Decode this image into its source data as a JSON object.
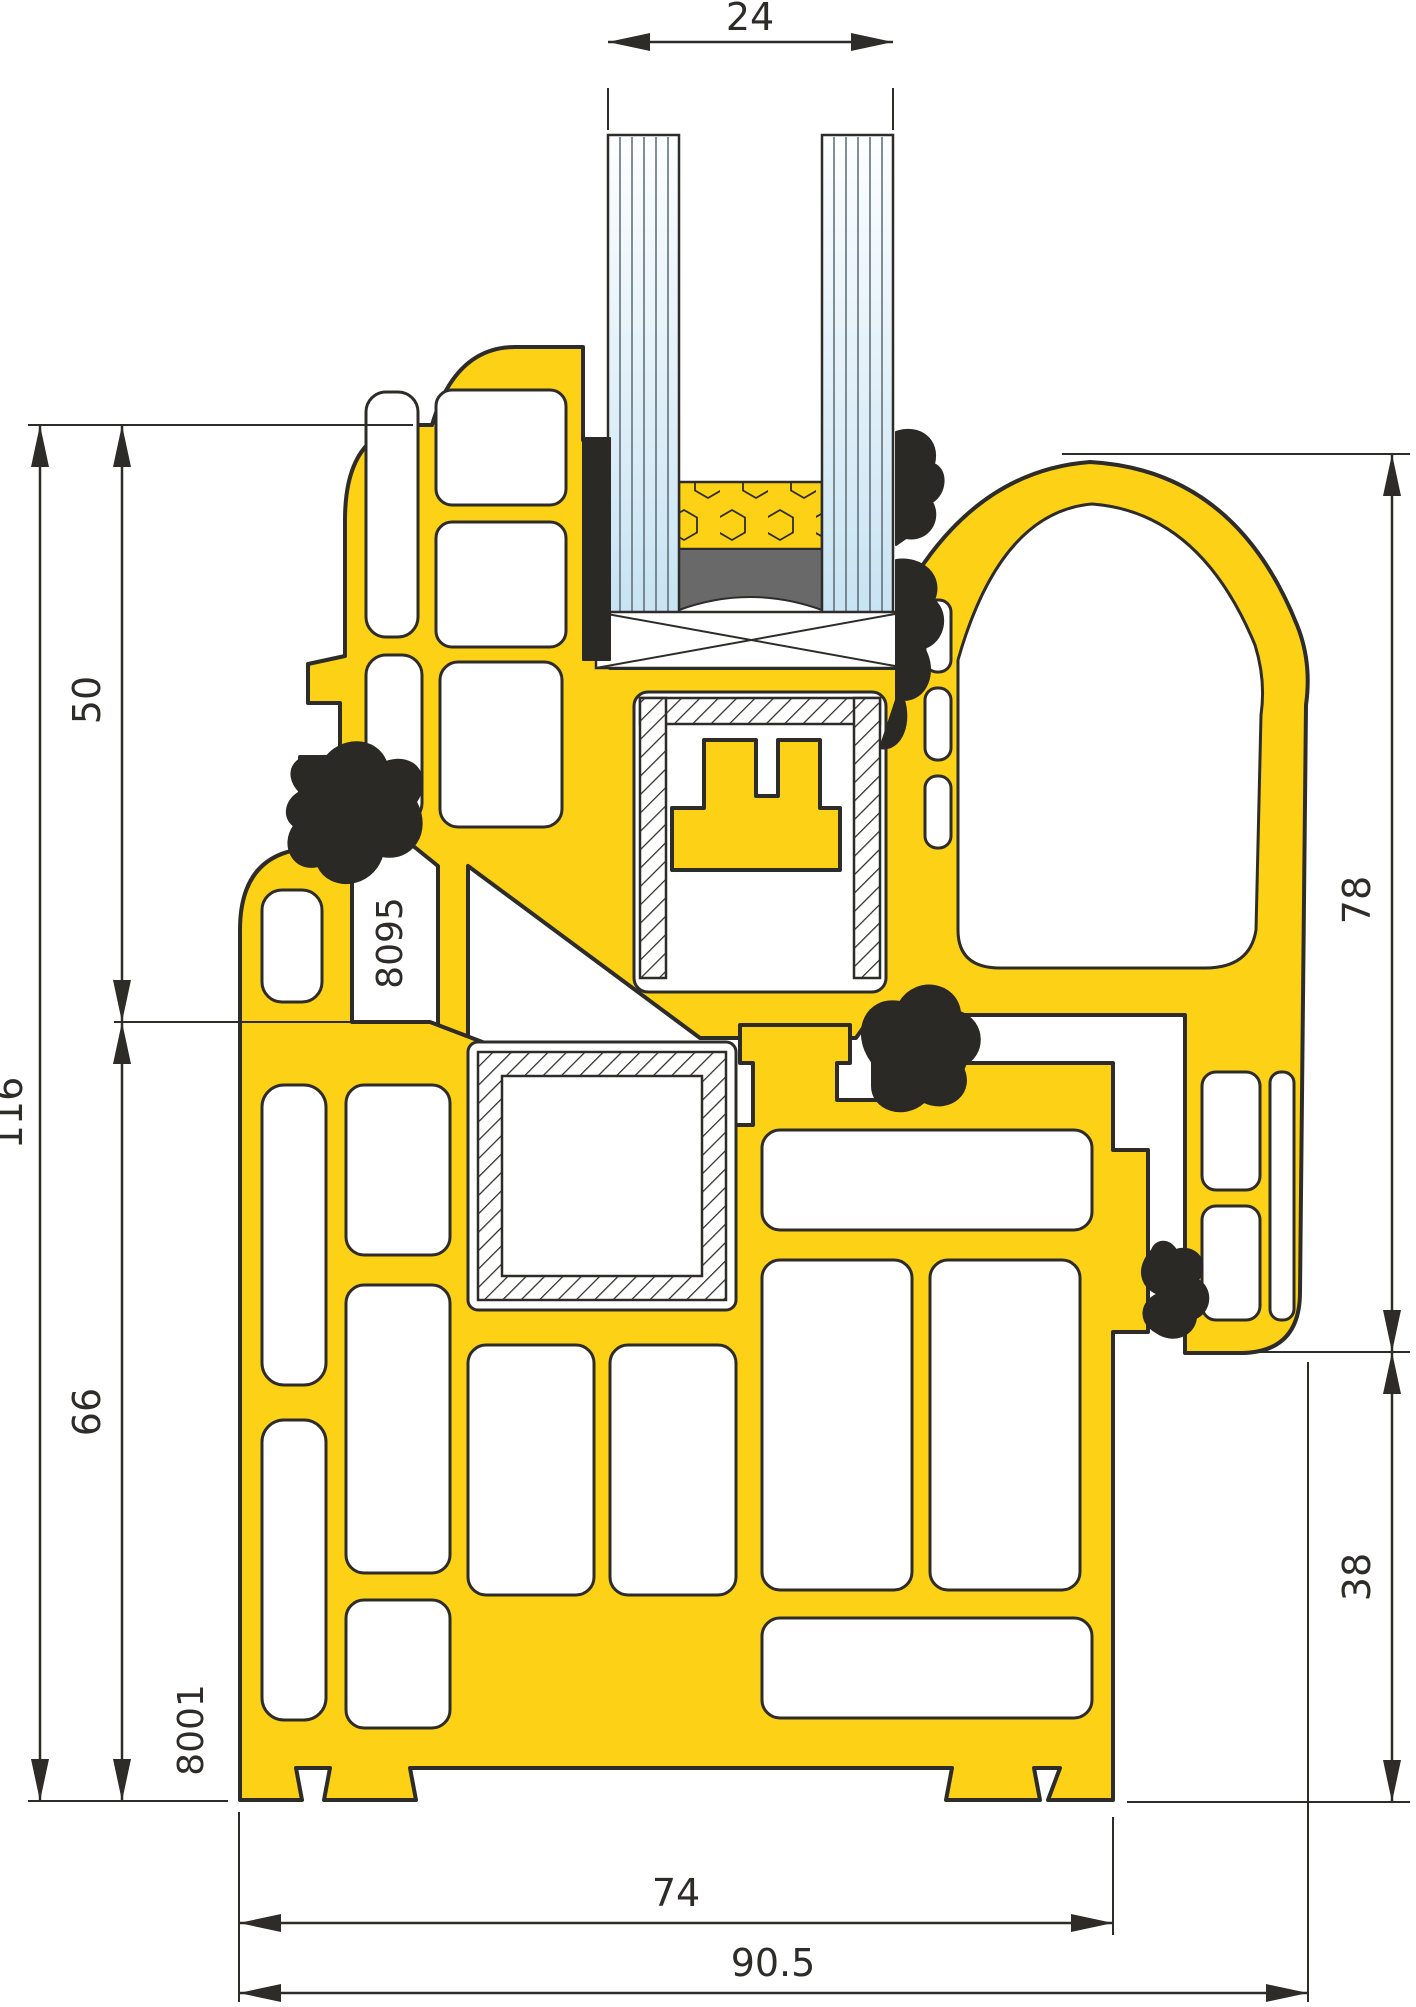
{
  "drawing": {
    "dims": {
      "glass_unit_width": "24",
      "upper_section_height": "50",
      "total_height": "116",
      "frame_height": "66",
      "sash_height": "78",
      "rebate_height": "38",
      "frame_depth": "74",
      "overall_depth": "90.5"
    },
    "labels": {
      "seal_code": "8095",
      "frame_profile_code": "8001"
    },
    "colors": {
      "profile_yellow": "#FCD116",
      "outline_dark": "#2E2C28",
      "gasket_black": "#2A2925",
      "sealant_gray": "#696969",
      "glass_blue": "#C8E3F3"
    }
  }
}
